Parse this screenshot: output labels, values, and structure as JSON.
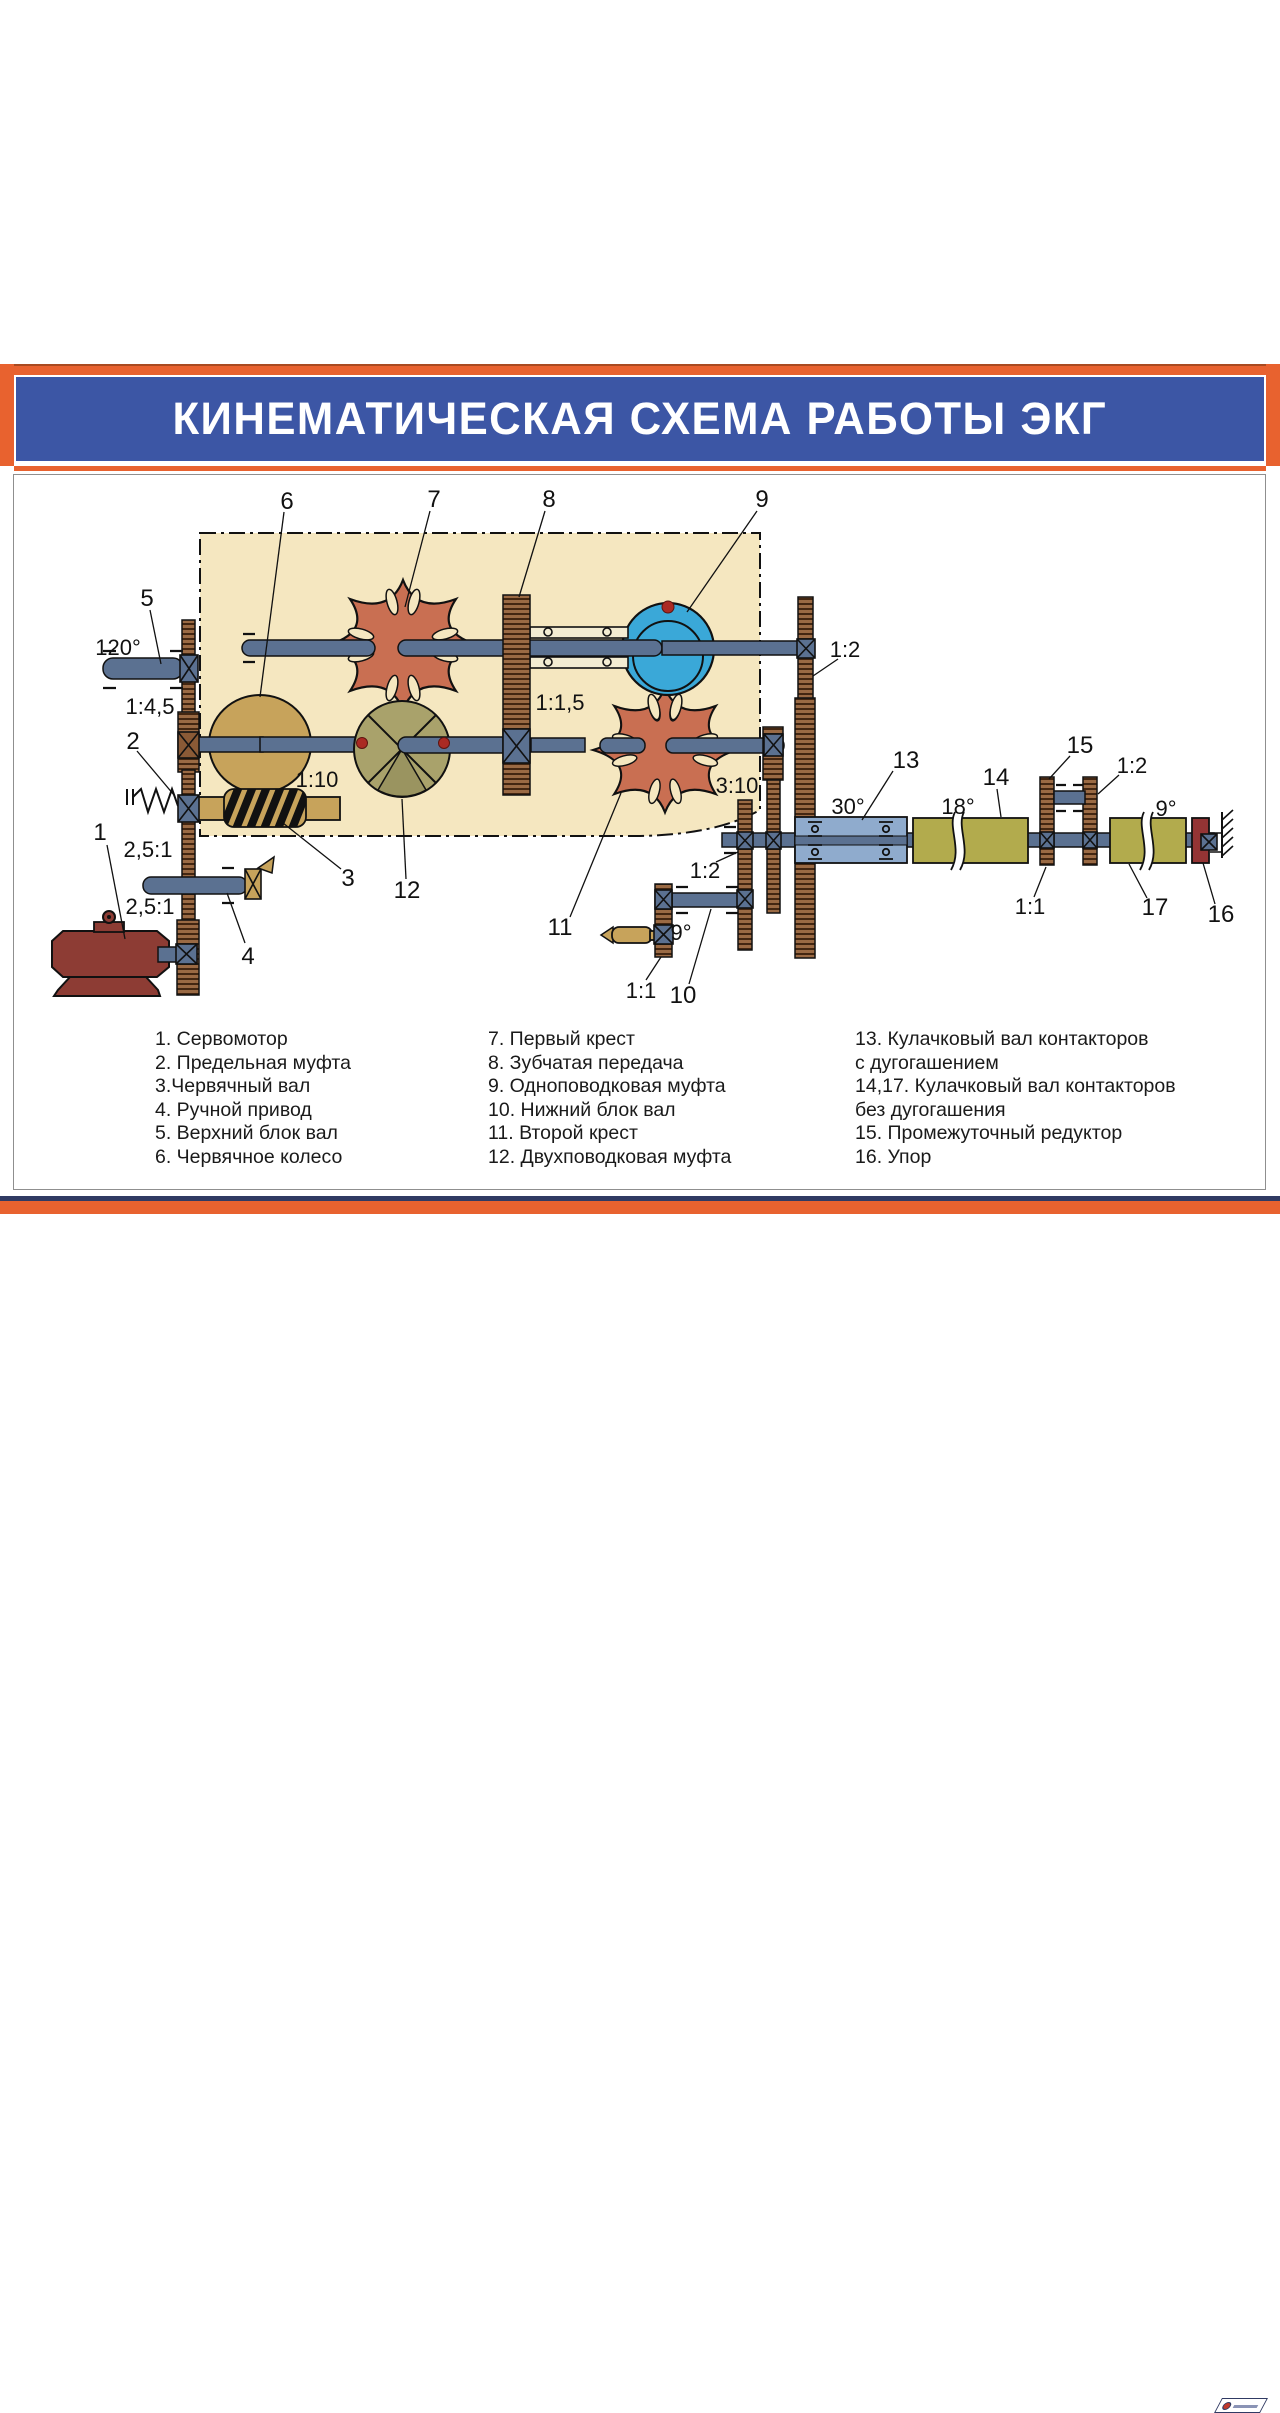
{
  "title": "КИНЕМАТИЧЕСКАЯ СХЕМА РАБОТЫ ЭКГ",
  "colors": {
    "frame_orange": "#e8622f",
    "banner_blue": "#3c56a5",
    "footer_navy": "#303a63",
    "panel_beige": "#f5e7c0",
    "rack_brown": "#9a6a44",
    "shaft_steel": "#5b7191",
    "star_red": "#c96f52",
    "wheel_tan": "#c7a35b",
    "clutch_blue": "#3aa8d8",
    "clutch_olive": "#a9a26b",
    "housing_blue": "#8fabcd",
    "cam_olive": "#b2ab4d",
    "motor_red": "#8d3c34",
    "marker_red": "#ab2a23"
  },
  "diagram": {
    "numbers": {
      "n1": "1",
      "n2": "2",
      "n3": "3",
      "n4": "4",
      "n5": "5",
      "n6": "6",
      "n7": "7",
      "n8": "8",
      "n9": "9",
      "n10": "10",
      "n11": "11",
      "n12": "12",
      "n13": "13",
      "n14": "14",
      "n15": "15",
      "n16": "16",
      "n17": "17"
    },
    "ratios": {
      "deg120": "120°",
      "r145": "1:4,5",
      "r110": "1:10",
      "r251a": "2,5:1",
      "r251b": "2,5:1",
      "r115": "1:1,5",
      "r310": "3:10",
      "r12top": "1:2",
      "r12mid": "1:2",
      "deg9left": "9°",
      "r11left": "1:1",
      "deg30": "30°",
      "deg18": "18°",
      "r12right": "1:2",
      "r11right": "1:1",
      "deg9right": "9°"
    }
  },
  "legend": {
    "col1": [
      "1. Сервомотор",
      "2. Предельная муфта",
      "3.Червячный вал",
      "4. Ручной привод",
      "5. Верхний блок вал",
      "6. Червячное колесо"
    ],
    "col2": [
      "7. Первый крест",
      "8. Зубчатая передача",
      "9. Одноповодковая муфта",
      "10. Нижний блок вал",
      "11. Второй крест",
      "12. Двухповодковая муфта"
    ],
    "col3": [
      "13. Кулачковый вал контакторов",
      "с дугогашением",
      "14,17. Кулачковый вал контакторов",
      "без дугогашения",
      "15. Промежуточный редуктор",
      "16. Упор"
    ]
  }
}
